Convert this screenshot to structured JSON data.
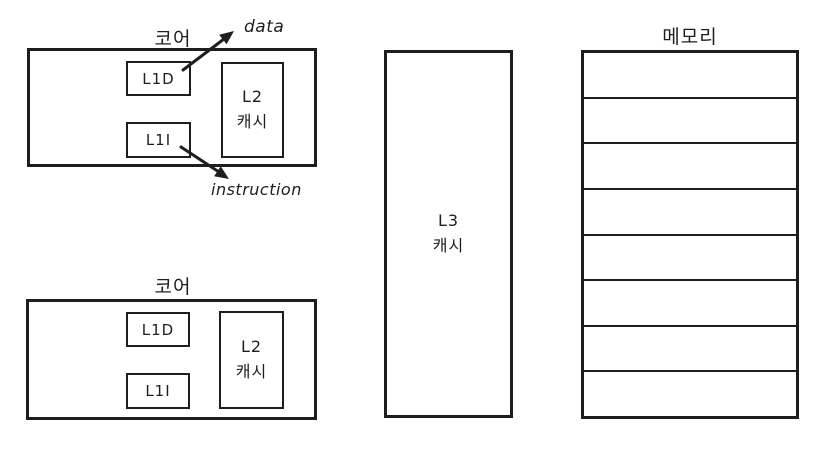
{
  "colors": {
    "stroke": "#1e1e1e",
    "background": "#ffffff"
  },
  "cores": [
    {
      "label": "코어",
      "l1d_label": "L1D",
      "l1i_label": "L1I",
      "l2_label_line1": "L2",
      "l2_label_line2": "캐시"
    },
    {
      "label": "코어",
      "l1d_label": "L1D",
      "l1i_label": "L1I",
      "l2_label_line1": "L2",
      "l2_label_line2": "캐시"
    }
  ],
  "l3": {
    "label_line1": "L3",
    "label_line2": "캐시"
  },
  "memory": {
    "label": "메모리",
    "row_count": 8
  },
  "annotations": {
    "data_label": "data",
    "instruction_label": "instruction"
  }
}
